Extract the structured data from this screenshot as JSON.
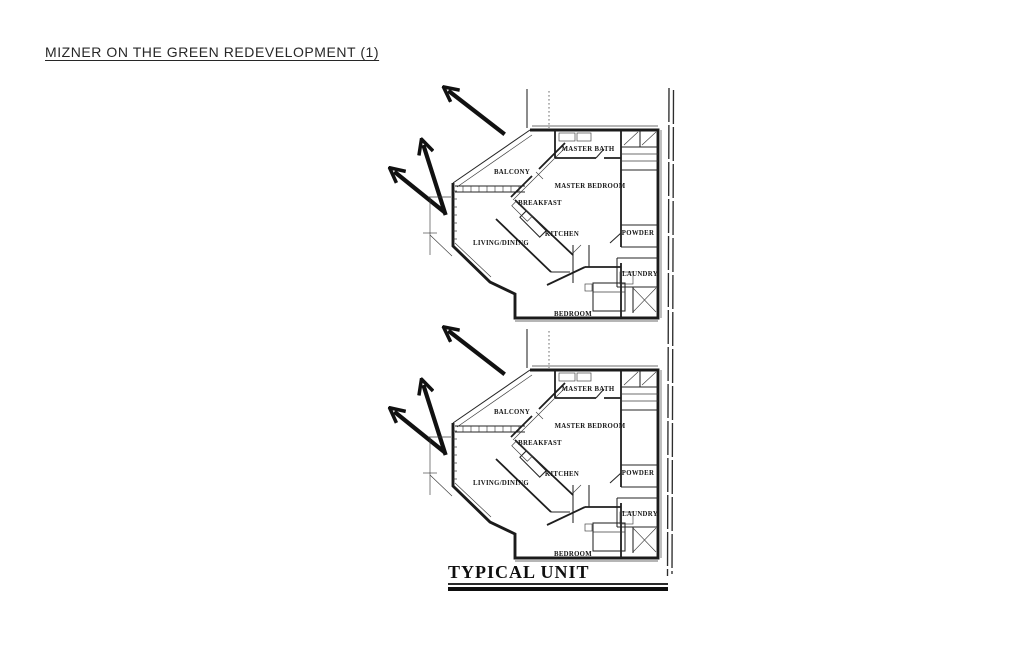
{
  "document": {
    "title": "MIZNER ON THE GREEN REDEVELOPMENT (1)",
    "drawing_caption": "TYPICAL UNIT"
  },
  "plan": {
    "unit_count": 2,
    "rooms": {
      "master_bath": "MASTER BATH",
      "balcony": "BALCONY",
      "master_bedroom": "MASTER BEDROOM",
      "breakfast": "BREAKFAST",
      "kitchen": "KITCHEN",
      "living_dining": "LIVING/DINING",
      "powder": "POWDER",
      "laundry": "LAUNDRY",
      "bedroom": "BEDROOM"
    },
    "colors": {
      "ink": "#1b1b1b",
      "paper": "#ffffff"
    }
  }
}
